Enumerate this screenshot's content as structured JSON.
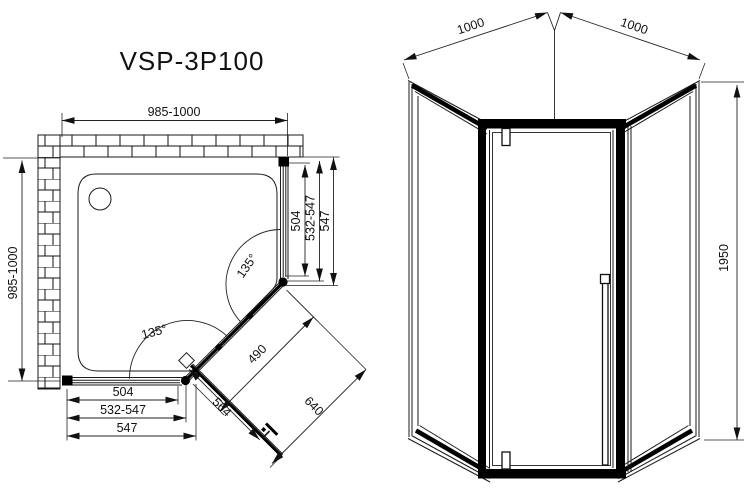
{
  "title": "VSP-3P100",
  "colors": {
    "line": "#1a1a1a",
    "background": "#ffffff"
  },
  "plan_view": {
    "width_top": "985-1000",
    "depth_left": "985-1000",
    "right_side": {
      "glass_width": "504",
      "adjust_range": "532-547",
      "panel_total": "547"
    },
    "bottom_side": {
      "glass_width": "504",
      "adjust_range": "532-547",
      "panel_total": "547"
    },
    "door_fixed_glass": "490",
    "door_width": "564",
    "entry_width": "640",
    "corner_angle_right": "135°",
    "corner_angle_bottom": "135°"
  },
  "front_view": {
    "side_width_left": "1000",
    "side_width_right": "1000",
    "height": "1950"
  }
}
